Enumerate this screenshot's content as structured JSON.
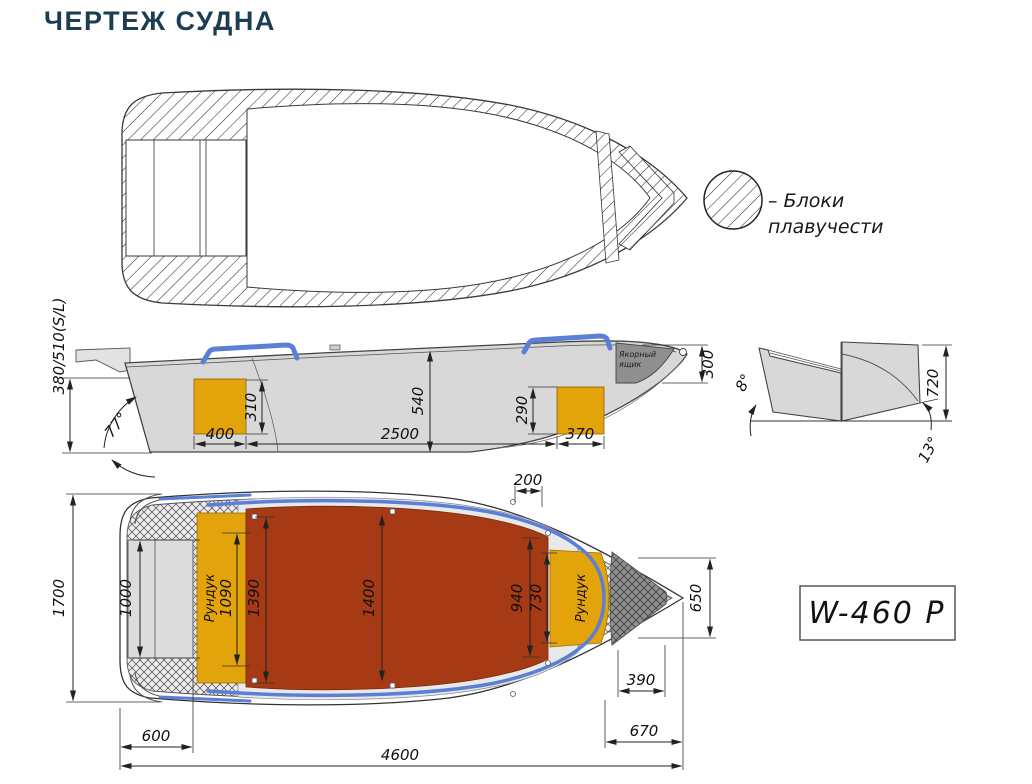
{
  "title": "ЧЕРТЕЖ СУДНА",
  "legend": {
    "line1": "– Блоки",
    "line2": "плавучести"
  },
  "model_badge": "W-460 P",
  "side_view": {
    "transom_height": "380/510(S/L)",
    "transom_angle": "77°",
    "stern_locker_height": "310",
    "midship_depth": "540",
    "bow_locker_height": "290",
    "anchor_box_height": "300",
    "stern_locker_length": "400",
    "cockpit_length": "2500",
    "bow_locker_length": "370",
    "anchor_box_line1": "Якорный",
    "anchor_box_line2": "ящик"
  },
  "section_view": {
    "flare_angle": "8°",
    "depth": "720",
    "deadrise_angle": "13°"
  },
  "plan_view": {
    "beam_overall": "1700",
    "platform_width": "1000",
    "stern_locker_label": "Рундук",
    "stern_locker_width": "1090",
    "floor_width_aft": "1390",
    "floor_width_mid": "1400",
    "floor_width_fwd": "940",
    "bow_locker_width": "730",
    "bow_width": "650",
    "bow_gap": "200",
    "anchor_well_length": "390",
    "stern_platform_length": "600",
    "bow_deck_length": "670",
    "length_overall": "4600",
    "bow_locker_label": "Рундук"
  },
  "colors": {
    "deck_red": "#A63A15",
    "locker_yellow": "#E3A30B",
    "rail_blue": "#5B7FD6",
    "hull_gray": "#D8D8D8",
    "anchor_gray": "#8F8F8F",
    "title_navy": "#1C3D52"
  }
}
